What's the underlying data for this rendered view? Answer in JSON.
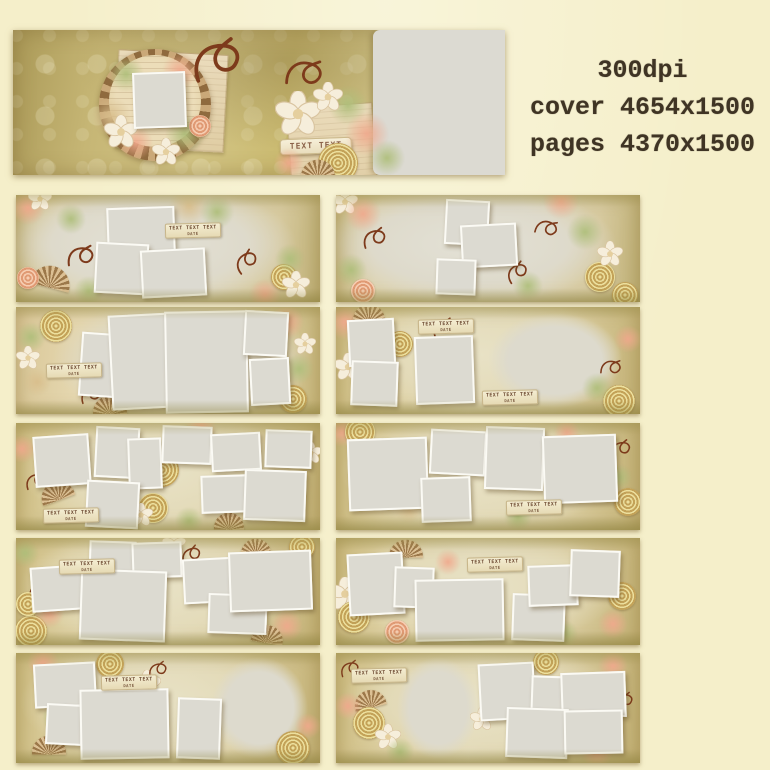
{
  "specs": {
    "line1": "300dpi",
    "line2": "cover 4654x1500",
    "line3": "pages 4370x1500"
  },
  "tag": {
    "line1": "TEXT TEXT TEXT",
    "line2": "DATE"
  },
  "palette": {
    "background": "#f5efca",
    "cover_olive": "#c6b675",
    "photo_gray": "#dcdad1",
    "photo_border": "#fbfaf4",
    "swirl": "#7d3a1b",
    "blossom": "#f6eedb",
    "blossom_edge": "#d9c4a0",
    "blossom_core": "#e5cf9e",
    "rose_gold": "#c3a258",
    "rose_pink": "#e09a74",
    "leaf_green": "#aebe7a",
    "leaf_pink": "#f0a88c",
    "ink": "#3f3424"
  },
  "cover": {
    "label": "TEXT TEXT",
    "label_pos": [
      61.5,
      80
    ],
    "papers": [
      [
        21,
        15,
        22,
        66,
        3
      ],
      [
        56,
        52,
        17,
        58,
        -4
      ]
    ],
    "photo": [
      24.4,
      29,
      10,
      36,
      -2
    ],
    "right_placeholder": [
      73.2,
      0,
      26.8,
      100
    ],
    "decor": [
      [
        "burst",
        28.9,
        52,
        112,
        0
      ],
      [
        "disc",
        28.9,
        49,
        92,
        0
      ],
      [
        "leafG",
        23,
        30,
        36,
        0
      ],
      [
        "leafP",
        34,
        28,
        36,
        0
      ],
      [
        "leafT",
        20,
        60,
        40,
        0
      ],
      [
        "leafG",
        35,
        72,
        40,
        0
      ],
      [
        "leafP",
        25,
        78,
        34,
        0
      ],
      [
        "blossom",
        22,
        70,
        34,
        0
      ],
      [
        "blossom",
        31,
        84,
        28,
        0
      ],
      [
        "roseP",
        38,
        66,
        22,
        0
      ],
      [
        "swirl",
        42,
        18,
        62,
        0
      ],
      [
        "swirl",
        60,
        28,
        46,
        20
      ],
      [
        "leafG",
        68,
        52,
        40,
        0
      ],
      [
        "leafP",
        72,
        72,
        44,
        0
      ],
      [
        "blossom",
        58,
        58,
        46,
        0
      ],
      [
        "blossom",
        64,
        46,
        30,
        0
      ],
      [
        "roseG",
        66,
        92,
        40,
        0
      ],
      [
        "leafG",
        76,
        88,
        36,
        0
      ],
      [
        "fan",
        62,
        96,
        34,
        0
      ],
      [
        "leafP",
        56,
        92,
        30,
        0
      ]
    ]
  },
  "pages": [
    {
      "col": 0,
      "row": 0,
      "bg": "A",
      "photos": [
        [
          30,
          11,
          21,
          40,
          -2
        ],
        [
          26,
          45,
          16,
          44,
          3
        ],
        [
          41,
          50,
          20,
          41,
          -3
        ]
      ],
      "blobs": [],
      "tags": [
        [
          49,
          26
        ]
      ],
      "decor": [
        [
          "leafP",
          4,
          12,
          34,
          0
        ],
        [
          "blossom",
          8,
          4,
          24,
          0
        ],
        [
          "leafG",
          18,
          22,
          30,
          0
        ],
        [
          "fan",
          12,
          77,
          40,
          15
        ],
        [
          "roseP",
          4,
          78,
          22,
          0
        ],
        [
          "leafG",
          24,
          90,
          30,
          0
        ],
        [
          "swirl",
          22,
          55,
          34,
          10
        ],
        [
          "leafT",
          57,
          10,
          40,
          0
        ],
        [
          "leafG",
          66,
          16,
          34,
          0
        ],
        [
          "roseG",
          88,
          77,
          26,
          0
        ],
        [
          "blossom",
          92,
          84,
          28,
          0
        ],
        [
          "leafP",
          82,
          93,
          32,
          0
        ],
        [
          "swirl",
          76,
          60,
          30,
          -20
        ],
        [
          "leafG",
          90,
          60,
          30,
          0
        ]
      ]
    },
    {
      "col": 1,
      "row": 0,
      "bg": "A",
      "photos": [
        [
          36,
          5,
          13,
          38,
          3
        ],
        [
          41,
          27,
          17,
          36,
          -3
        ],
        [
          33,
          60,
          12,
          30,
          2
        ]
      ],
      "blobs": [],
      "tags": [],
      "decor": [
        [
          "blossom",
          3,
          7,
          26,
          0
        ],
        [
          "leafP",
          9,
          18,
          36,
          0
        ],
        [
          "swirl",
          13,
          38,
          30,
          0
        ],
        [
          "leafG",
          5,
          70,
          32,
          0
        ],
        [
          "roseP",
          9,
          90,
          24,
          0
        ],
        [
          "leafP",
          74,
          6,
          36,
          0
        ],
        [
          "swirl",
          70,
          30,
          28,
          30
        ],
        [
          "leafG",
          82,
          35,
          36,
          0
        ],
        [
          "roseG",
          87,
          77,
          30,
          0
        ],
        [
          "roseG",
          95,
          93,
          26,
          0
        ],
        [
          "blossom",
          90,
          55,
          26,
          0
        ],
        [
          "leafG",
          63,
          85,
          30,
          0
        ],
        [
          "swirl",
          60,
          70,
          28,
          -15
        ]
      ]
    },
    {
      "col": 0,
      "row": 1,
      "bg": "B",
      "photos": [
        [
          21,
          24,
          12,
          56,
          4
        ],
        [
          31,
          7,
          20,
          85,
          -3
        ],
        [
          49,
          4,
          26,
          92,
          -1
        ],
        [
          75,
          4,
          13,
          38,
          3
        ],
        [
          77,
          48,
          12,
          40,
          -3
        ]
      ],
      "blobs": [],
      "tags": [
        [
          10,
          52
        ]
      ],
      "decor": [
        [
          "roseG",
          13,
          18,
          32,
          0
        ],
        [
          "leafG",
          5,
          28,
          30,
          0
        ],
        [
          "blossom",
          4,
          48,
          24,
          0
        ],
        [
          "leafT",
          7,
          70,
          28,
          0
        ],
        [
          "leafP",
          89,
          14,
          34,
          0
        ],
        [
          "leafG",
          93,
          58,
          30,
          0
        ],
        [
          "roseG",
          91,
          86,
          28,
          0
        ],
        [
          "fan",
          31,
          92,
          34,
          0
        ],
        [
          "swirl",
          25,
          80,
          26,
          0
        ],
        [
          "blossom",
          95,
          35,
          22,
          0
        ]
      ]
    },
    {
      "col": 1,
      "row": 1,
      "bg": "C",
      "photos": [
        [
          4,
          11,
          14,
          40,
          -3
        ],
        [
          5,
          50,
          14,
          38,
          2
        ],
        [
          26,
          27,
          18,
          60,
          -2
        ]
      ],
      "blobs": [
        [
          50,
          6,
          44,
          88
        ]
      ],
      "tags": [
        [
          27,
          11
        ],
        [
          48,
          78
        ]
      ],
      "decor": [
        [
          "leafP",
          3,
          14,
          36,
          0
        ],
        [
          "fan",
          11,
          6,
          32,
          0
        ],
        [
          "blossom",
          4,
          56,
          28,
          0
        ],
        [
          "leafG",
          13,
          80,
          32,
          0
        ],
        [
          "roseG",
          21,
          35,
          26,
          0
        ],
        [
          "swirl",
          36,
          18,
          28,
          0
        ],
        [
          "roseG",
          93,
          88,
          32,
          0
        ],
        [
          "leafG",
          86,
          76,
          30,
          0
        ],
        [
          "leafP",
          96,
          30,
          28,
          0
        ],
        [
          "swirl",
          91,
          55,
          26,
          20
        ]
      ]
    },
    {
      "col": 0,
      "row": 2,
      "bg": "C",
      "photos": [
        [
          6,
          11,
          17,
          44,
          -4
        ],
        [
          26,
          4,
          13,
          44,
          3
        ],
        [
          37,
          14,
          10,
          44,
          -2
        ],
        [
          48,
          3,
          15,
          32,
          2
        ],
        [
          64,
          9,
          15,
          32,
          -3
        ],
        [
          82,
          7,
          14,
          32,
          2
        ],
        [
          23,
          54,
          16,
          40,
          3
        ],
        [
          61,
          49,
          15,
          32,
          -2
        ],
        [
          75,
          44,
          19,
          44,
          2
        ]
      ],
      "blobs": [],
      "tags": [
        [
          9,
          79
        ]
      ],
      "decor": [
        [
          "roseG",
          48,
          44,
          34,
          0
        ],
        [
          "roseG",
          45,
          79,
          30,
          0
        ],
        [
          "blossom",
          41,
          86,
          24,
          0
        ],
        [
          "leafP",
          61,
          4,
          30,
          0
        ],
        [
          "fan",
          13,
          64,
          34,
          -20
        ],
        [
          "swirl",
          7,
          52,
          26,
          0
        ],
        [
          "leafP",
          2,
          24,
          28,
          0
        ],
        [
          "blossom",
          97,
          28,
          22,
          0
        ],
        [
          "leafG",
          57,
          92,
          28,
          0
        ],
        [
          "fan",
          70,
          92,
          30,
          0
        ]
      ]
    },
    {
      "col": 1,
      "row": 2,
      "bg": "C",
      "photos": [
        [
          4,
          14,
          25,
          64,
          -2
        ],
        [
          31,
          7,
          17,
          38,
          3
        ],
        [
          28,
          50,
          15,
          38,
          -2
        ],
        [
          49,
          4,
          18,
          55,
          2
        ],
        [
          68,
          11,
          23,
          60,
          -2
        ]
      ],
      "blobs": [],
      "tags": [
        [
          56,
          72
        ]
      ],
      "decor": [
        [
          "leafP",
          2,
          8,
          30,
          0
        ],
        [
          "roseG",
          8,
          8,
          30,
          0
        ],
        [
          "leafT",
          24,
          80,
          28,
          0
        ],
        [
          "blossom",
          36,
          76,
          26,
          0
        ],
        [
          "roseG",
          96,
          74,
          28,
          0
        ],
        [
          "swirl",
          94,
          22,
          26,
          0
        ],
        [
          "leafP",
          76,
          8,
          26,
          0
        ],
        [
          "leafG",
          60,
          88,
          28,
          0
        ],
        [
          "swirl",
          56,
          35,
          24,
          15
        ],
        [
          "leafG",
          93,
          50,
          26,
          0
        ]
      ]
    },
    {
      "col": 0,
      "row": 3,
      "bg": "C",
      "photos": [
        [
          5,
          26,
          16,
          38,
          -4
        ],
        [
          24,
          3,
          14,
          32,
          2
        ],
        [
          38,
          4,
          15,
          30,
          -2
        ],
        [
          21,
          30,
          27,
          63,
          2
        ],
        [
          55,
          19,
          17,
          38,
          -3
        ],
        [
          63,
          52,
          18,
          34,
          2
        ],
        [
          70,
          12,
          26,
          52,
          -2
        ]
      ],
      "blobs": [],
      "tags": [
        [
          14,
          20
        ]
      ],
      "decor": [
        [
          "roseG",
          5,
          87,
          32,
          0
        ],
        [
          "leafP",
          11,
          70,
          30,
          0
        ],
        [
          "swirl",
          8,
          48,
          26,
          0
        ],
        [
          "leafG",
          3,
          14,
          28,
          0
        ],
        [
          "blossom",
          52,
          6,
          24,
          0
        ],
        [
          "swirl",
          58,
          14,
          26,
          -10
        ],
        [
          "fan",
          79,
          8,
          30,
          0
        ],
        [
          "roseG",
          94,
          8,
          26,
          0
        ],
        [
          "leafP",
          89,
          82,
          32,
          0
        ],
        [
          "fan",
          83,
          90,
          32,
          10
        ],
        [
          "roseG",
          4,
          62,
          24,
          0
        ]
      ]
    },
    {
      "col": 1,
      "row": 3,
      "bg": "C",
      "photos": [
        [
          4,
          14,
          17,
          54,
          -3
        ],
        [
          19,
          27,
          12,
          35,
          2
        ],
        [
          26,
          38,
          28,
          54,
          -1
        ],
        [
          58,
          52,
          16,
          40,
          2
        ],
        [
          63,
          25,
          15,
          35,
          -2
        ],
        [
          77,
          11,
          15,
          40,
          2
        ]
      ],
      "blobs": [],
      "tags": [
        [
          43,
          18
        ]
      ],
      "decor": [
        [
          "blossom",
          3,
          52,
          34,
          0
        ],
        [
          "roseG",
          6,
          74,
          32,
          0
        ],
        [
          "fan",
          23,
          10,
          34,
          0
        ],
        [
          "leafP",
          37,
          22,
          26,
          0
        ],
        [
          "leafG",
          46,
          86,
          30,
          0
        ],
        [
          "roseG",
          94,
          54,
          28,
          0
        ],
        [
          "leafP",
          91,
          80,
          30,
          0
        ],
        [
          "swirl",
          89,
          33,
          24,
          0
        ],
        [
          "leafG",
          75,
          90,
          28,
          0
        ],
        [
          "roseP",
          20,
          88,
          24,
          0
        ]
      ]
    },
    {
      "col": 0,
      "row": 4,
      "bg": "C",
      "photos": [
        [
          6,
          9,
          19,
          36,
          -3
        ],
        [
          10,
          46,
          11,
          34,
          3
        ],
        [
          21,
          33,
          28,
          60,
          -1
        ],
        [
          53,
          41,
          13,
          52,
          2
        ]
      ],
      "blobs": [
        [
          64,
          4,
          32,
          92
        ]
      ],
      "tags": [
        [
          28,
          20
        ]
      ],
      "decor": [
        [
          "leafP",
          9,
          8,
          32,
          0
        ],
        [
          "roseG",
          31,
          10,
          28,
          0
        ],
        [
          "blossom",
          43,
          28,
          28,
          0
        ],
        [
          "swirl",
          42,
          48,
          28,
          0
        ],
        [
          "leafG",
          13,
          58,
          28,
          0
        ],
        [
          "fan",
          11,
          84,
          34,
          0
        ],
        [
          "roseG",
          91,
          86,
          34,
          0
        ],
        [
          "leafP",
          96,
          66,
          26,
          0
        ],
        [
          "blossom",
          37,
          60,
          22,
          0
        ],
        [
          "swirl",
          47,
          14,
          24,
          0
        ]
      ]
    },
    {
      "col": 1,
      "row": 4,
      "bg": "C",
      "photos": [
        [
          47,
          9,
          17,
          48,
          -3
        ],
        [
          64,
          21,
          13,
          34,
          2
        ],
        [
          74,
          17,
          20,
          38,
          -2
        ],
        [
          56,
          50,
          19,
          42,
          2
        ],
        [
          75,
          52,
          18,
          36,
          -1
        ]
      ],
      "blobs": [
        [
          20,
          4,
          27,
          92
        ]
      ],
      "tags": [
        [
          5,
          14
        ]
      ],
      "decor": [
        [
          "swirl",
          5,
          13,
          24,
          0
        ],
        [
          "fan",
          11,
          42,
          32,
          -15
        ],
        [
          "roseG",
          11,
          64,
          32,
          0
        ],
        [
          "blossom",
          17,
          76,
          26,
          0
        ],
        [
          "leafP",
          4,
          48,
          28,
          0
        ],
        [
          "leafG",
          21,
          90,
          28,
          0
        ],
        [
          "leafP",
          91,
          12,
          30,
          0
        ],
        [
          "roseG",
          69,
          8,
          26,
          0
        ],
        [
          "leafP",
          86,
          90,
          32,
          0
        ],
        [
          "swirl",
          95,
          42,
          24,
          0
        ],
        [
          "blossom",
          48,
          60,
          24,
          0
        ]
      ]
    }
  ]
}
